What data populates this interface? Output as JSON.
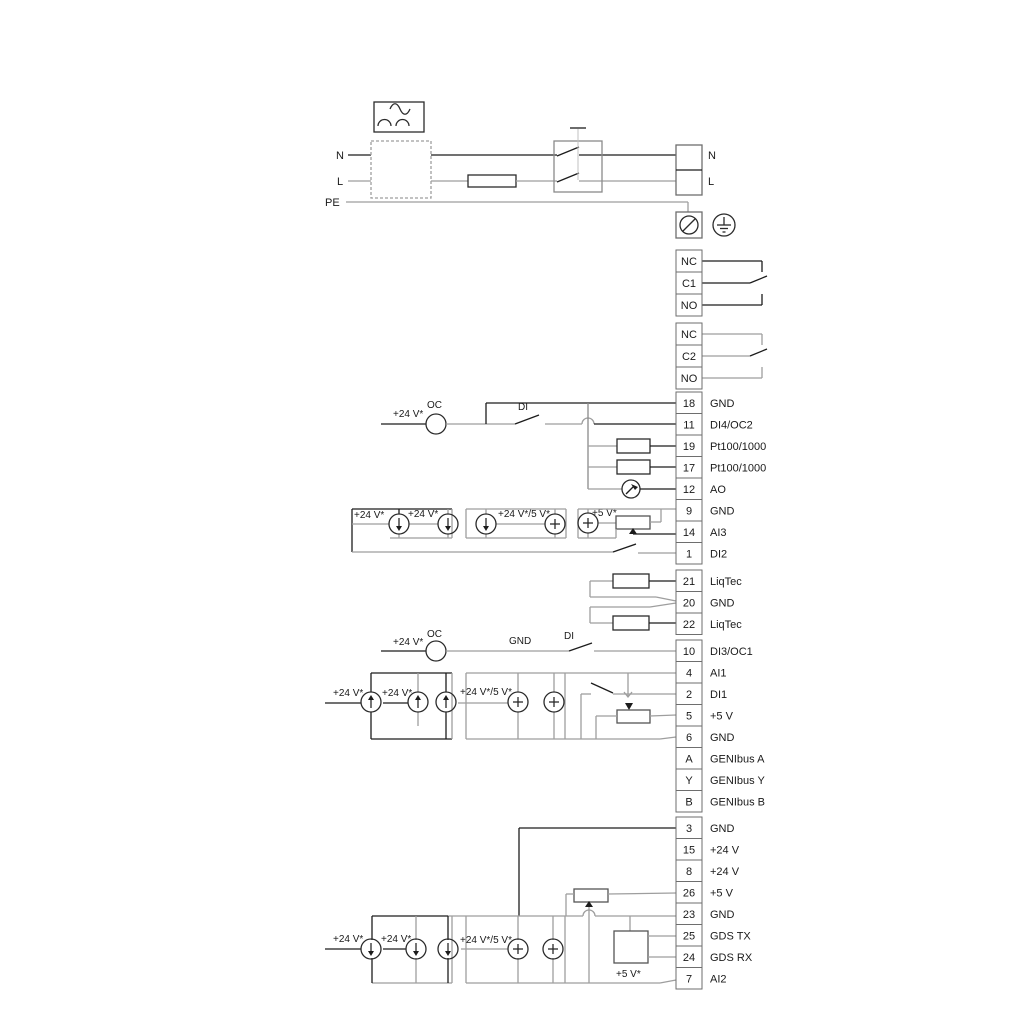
{
  "diagram_title": "pump-controller-wiring-diagram",
  "labels": {
    "plus24": "+24 V*",
    "plus24or5": "+24 V*/5 V*",
    "plus5": "+5 V*",
    "oc": "OC",
    "di": "DI",
    "gnd": "GND"
  },
  "power": {
    "n": "N",
    "l": "L",
    "pe": "PE"
  },
  "relays": [
    {
      "cells": [
        "NC",
        "C1",
        "NO"
      ]
    },
    {
      "cells": [
        "NC",
        "C2",
        "NO"
      ]
    }
  ],
  "terminal_groups": [
    {
      "name": "io-top",
      "terminals": [
        {
          "num": "18",
          "label": "GND"
        },
        {
          "num": "11",
          "label": "DI4/OC2"
        },
        {
          "num": "19",
          "label": "Pt100/1000"
        },
        {
          "num": "17",
          "label": "Pt100/1000"
        },
        {
          "num": "12",
          "label": "AO"
        },
        {
          "num": "9",
          "label": "GND"
        },
        {
          "num": "14",
          "label": "AI3"
        },
        {
          "num": "1",
          "label": "DI2"
        }
      ]
    },
    {
      "name": "liqtec",
      "terminals": [
        {
          "num": "21",
          "label": "LiqTec"
        },
        {
          "num": "20",
          "label": "GND"
        },
        {
          "num": "22",
          "label": "LiqTec"
        }
      ]
    },
    {
      "name": "io-mid",
      "terminals": [
        {
          "num": "10",
          "label": "DI3/OC1"
        },
        {
          "num": "4",
          "label": "AI1"
        },
        {
          "num": "2",
          "label": "DI1"
        },
        {
          "num": "5",
          "label": "+5 V"
        },
        {
          "num": "6",
          "label": "GND"
        },
        {
          "num": "A",
          "label": "GENIbus A"
        },
        {
          "num": "Y",
          "label": "GENIbus Y"
        },
        {
          "num": "B",
          "label": "GENIbus B"
        }
      ]
    },
    {
      "name": "io-bottom",
      "terminals": [
        {
          "num": "3",
          "label": "GND"
        },
        {
          "num": "15",
          "label": "+24 V"
        },
        {
          "num": "8",
          "label": "+24 V"
        },
        {
          "num": "26",
          "label": "+5 V"
        },
        {
          "num": "23",
          "label": "GND"
        },
        {
          "num": "25",
          "label": "GDS TX"
        },
        {
          "num": "24",
          "label": "GDS RX"
        },
        {
          "num": "7",
          "label": "AI2"
        }
      ]
    }
  ],
  "colors": {
    "wire_gray": "#9e9e9e",
    "wire_black": "#1c1c1c",
    "box_border": "#6e6e6e",
    "symbol_stroke": "#2b2b2b"
  }
}
